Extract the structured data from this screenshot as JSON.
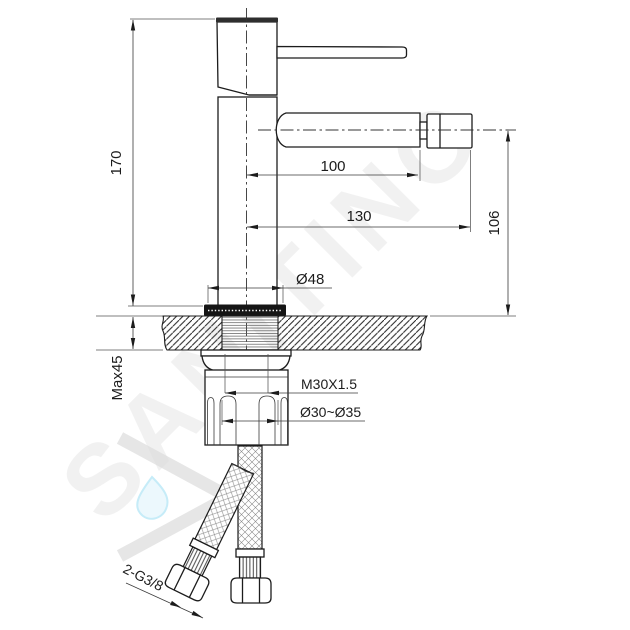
{
  "watermark": {
    "brand": "SANITINO"
  },
  "drawing": {
    "dimensions": {
      "height": "170",
      "spout_reach": "100",
      "overall_reach": "130",
      "outlet_height": "106",
      "base_diameter": "Ø48",
      "max_deck_thickness": "Max45",
      "mounting_thread": "M30X1.5",
      "hole_diameter": "Ø30~Ø35",
      "hose_connection": "2-G3/8"
    }
  }
}
